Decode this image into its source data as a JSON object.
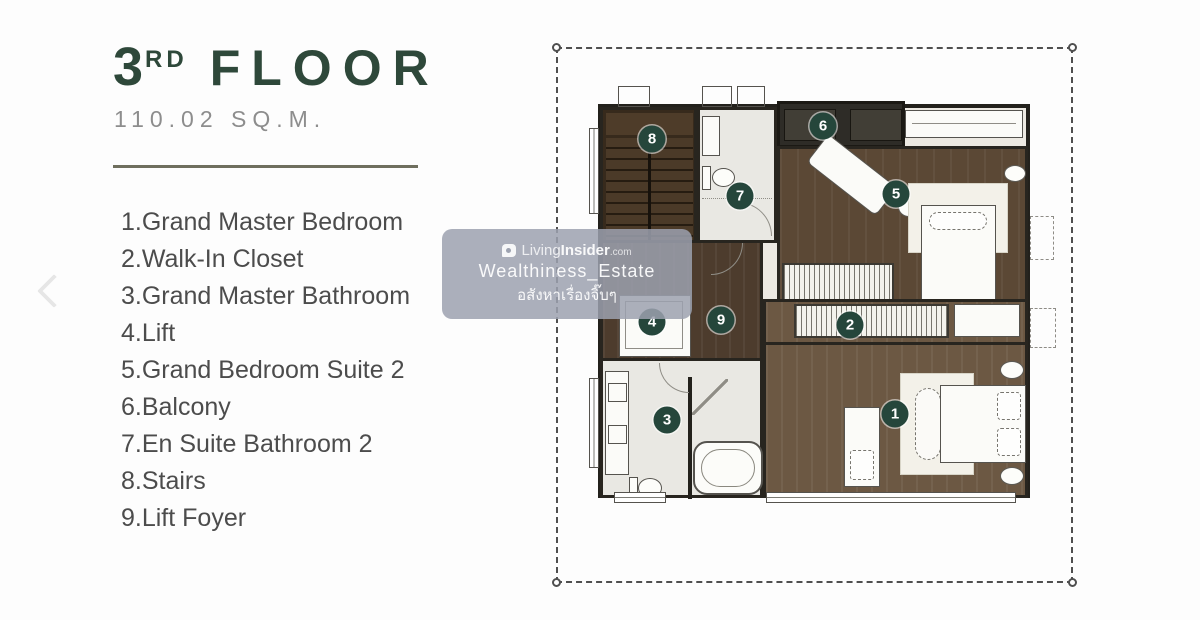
{
  "header": {
    "floor_number": "3",
    "floor_suffix": "RD",
    "floor_word": "FLOOR",
    "area": "110.02 SQ.M."
  },
  "legend": {
    "items": [
      "1.Grand Master Bedroom",
      "2.Walk-In Closet",
      "3.Grand Master Bathroom",
      "4.Lift",
      "5.Grand Bedroom Suite 2",
      "6.Balcony",
      "7.En Suite Bathroom 2",
      "8.Stairs",
      "9.Lift Foyer"
    ]
  },
  "plan": {
    "markers": [
      "1",
      "2",
      "3",
      "4",
      "5",
      "6",
      "7",
      "8",
      "9"
    ]
  },
  "watermark": {
    "brand_prefix": "Living",
    "brand_suffix": "Insider",
    "brand_tld": ".com",
    "account": "Wealthiness_Estate",
    "thai_line": "อสังหาเรื่องจิ๊บๆ"
  },
  "colors": {
    "accent_green": "#2e483a",
    "marker_green": "#25463b",
    "divider_olive": "#6f6f5e",
    "legend_text": "#4c4c4c",
    "area_text": "#8d8d8d",
    "wall": "#23211c",
    "wood_dark": "#5b4835",
    "wood_mid": "#6c5843",
    "bath_floor": "#e9e8e3",
    "watermark_bg": "#9ca1af"
  }
}
